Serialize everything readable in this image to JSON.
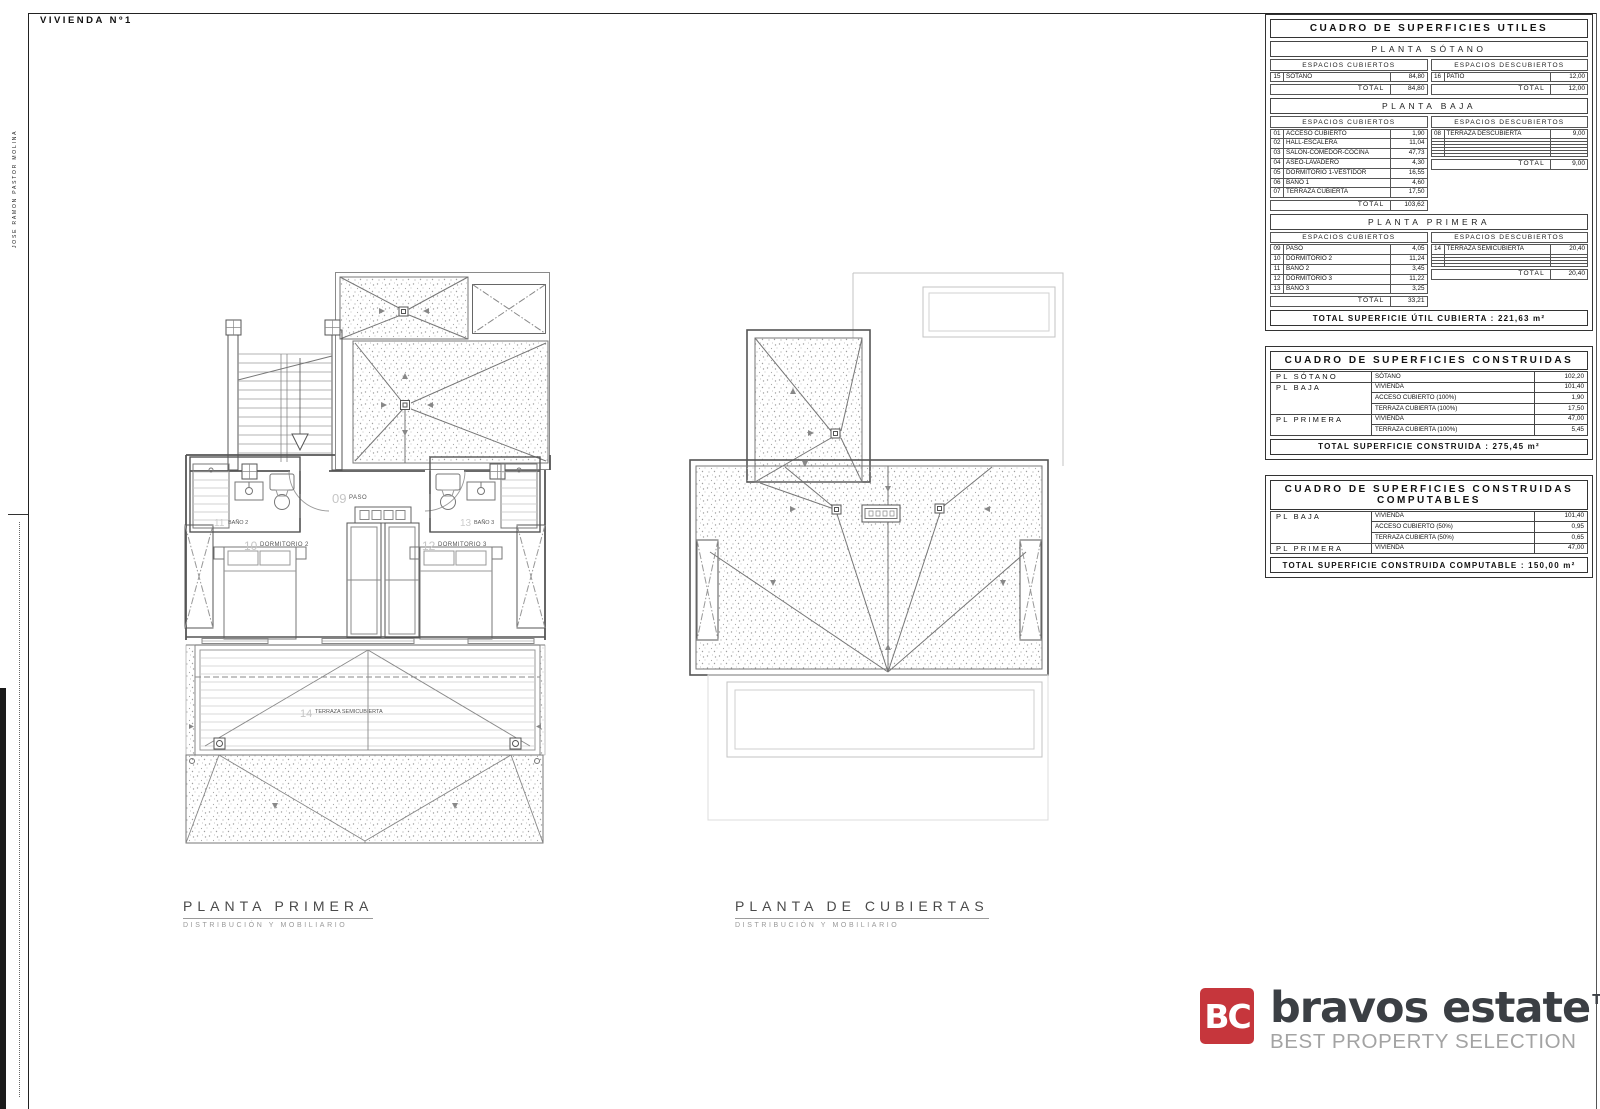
{
  "sheet": {
    "title": "VIVIENDA Nº1",
    "margin_text": "JOSÉ RAMÓN PASTOR MOLINA"
  },
  "tables": {
    "utiles": {
      "title": "CUADRO DE SUPERFICIES UTILES",
      "col_covered": "ESPACIOS CUBIERTOS",
      "col_uncovered": "ESPACIOS DESCUBIERTOS",
      "total_label": "TOTAL",
      "sections": [
        {
          "name": "PLANTA SÓTANO",
          "covered": [
            {
              "num": "15",
              "label": "SÓTANO",
              "value": "84,80"
            }
          ],
          "covered_total": "84,80",
          "uncovered": [
            {
              "num": "16",
              "label": "PATIO",
              "value": "12,00"
            }
          ],
          "uncovered_total": "12,00"
        },
        {
          "name": "PLANTA BAJA",
          "covered": [
            {
              "num": "01",
              "label": "ACCESO CUBIERTO",
              "value": "1,90"
            },
            {
              "num": "02",
              "label": "HALL-ESCALERA",
              "value": "11,04"
            },
            {
              "num": "03",
              "label": "SALÓN-COMEDOR-COCINA",
              "value": "47,73"
            },
            {
              "num": "04",
              "label": "ASEO-LAVADERO",
              "value": "4,30"
            },
            {
              "num": "05",
              "label": "DORMITORIO 1-VESTIDOR",
              "value": "16,55"
            },
            {
              "num": "06",
              "label": "BAÑO 1",
              "value": "4,60"
            },
            {
              "num": "07",
              "label": "TERRAZA CUBIERTA",
              "value": "17,50"
            }
          ],
          "covered_total": "103,62",
          "uncovered": [
            {
              "num": "08",
              "label": "TERRAZA DESCUBIERTA",
              "value": "9,00"
            },
            {
              "num": "",
              "label": "",
              "value": ""
            },
            {
              "num": "",
              "label": "",
              "value": ""
            },
            {
              "num": "",
              "label": "",
              "value": ""
            },
            {
              "num": "",
              "label": "",
              "value": ""
            },
            {
              "num": "",
              "label": "",
              "value": ""
            },
            {
              "num": "",
              "label": "",
              "value": ""
            }
          ],
          "uncovered_total": "9,00"
        },
        {
          "name": "PLANTA PRIMERA",
          "covered": [
            {
              "num": "09",
              "label": "PASO",
              "value": "4,05"
            },
            {
              "num": "10",
              "label": "DORMITORIO 2",
              "value": "11,24"
            },
            {
              "num": "11",
              "label": "BAÑO 2",
              "value": "3,45"
            },
            {
              "num": "12",
              "label": "DORMITORIO 3",
              "value": "11,22"
            },
            {
              "num": "13",
              "label": "BAÑO 3",
              "value": "3,25"
            }
          ],
          "covered_total": "33,21",
          "uncovered": [
            {
              "num": "14",
              "label": "TERRAZA SEMICUBIERTA",
              "value": "20,40"
            },
            {
              "num": "",
              "label": "",
              "value": ""
            },
            {
              "num": "",
              "label": "",
              "value": ""
            },
            {
              "num": "",
              "label": "",
              "value": ""
            },
            {
              "num": "",
              "label": "",
              "value": ""
            }
          ],
          "uncovered_total": "20,40"
        }
      ],
      "footer": "TOTAL SUPERFICIE ÚTIL CUBIERTA : 221,63 m²"
    },
    "construidas": {
      "title": "CUADRO DE SUPERFICIES CONSTRUIDAS",
      "rows": [
        {
          "group": "PL SÓTANO",
          "label": "SÓTANO",
          "value": "102,20"
        },
        {
          "group": "PL BAJA",
          "label": "VIVIENDA",
          "value": "101,40"
        },
        {
          "group": "",
          "label": "ACCESO CUBIERTO (100%)",
          "value": "1,90"
        },
        {
          "group": "",
          "label": "TERRAZA CUBIERTA (100%)",
          "value": "17,50"
        },
        {
          "group": "PL PRIMERA",
          "label": "VIVIENDA",
          "value": "47,00"
        },
        {
          "group": "",
          "label": "TERRAZA CUBIERTA (100%)",
          "value": "5,45"
        }
      ],
      "footer": "TOTAL SUPERFICIE CONSTRUIDA : 275,45 m²"
    },
    "computables": {
      "title_line1": "CUADRO DE SUPERFICIES CONSTRUIDAS",
      "title_line2": "COMPUTABLES",
      "rows": [
        {
          "group": "PL BAJA",
          "label": "VIVIENDA",
          "value": "101,40"
        },
        {
          "group": "",
          "label": "ACCESO CUBIERTO (50%)",
          "value": "0,95"
        },
        {
          "group": "",
          "label": "TERRAZA CUBIERTA (50%)",
          "value": "0,65"
        },
        {
          "group": "PL PRIMERA",
          "label": "VIVIENDA",
          "value": "47,00"
        }
      ],
      "footer": "TOTAL SUPERFICIE CONSTRUIDA COMPUTABLE : 150,00 m²"
    }
  },
  "plans": {
    "primera": {
      "title": "PLANTA PRIMERA",
      "subtitle": "DISTRIBUCIÓN Y MOBILIARIO",
      "rooms": {
        "paso": {
          "num": "09",
          "name": "PASO"
        },
        "dorm2": {
          "num": "10",
          "name": "DORMITORIO 2"
        },
        "bano2": {
          "num": "11",
          "name": "BAÑO 2"
        },
        "dorm3": {
          "num": "12",
          "name": "DORMITORIO 3"
        },
        "bano3": {
          "num": "13",
          "name": "BAÑO 3"
        },
        "terraza": {
          "num": "14",
          "name": "TERRAZA SEMICUBIERTA"
        }
      }
    },
    "cubiertas": {
      "title": "PLANTA DE CUBIERTAS",
      "subtitle": "DISTRIBUCIÓN Y MOBILIARIO"
    }
  },
  "logo": {
    "badge": "BC",
    "name": "bravos estate",
    "tm": "TM",
    "tagline": "BEST PROPERTY SELECTION",
    "brand_red": "#c6363c"
  }
}
